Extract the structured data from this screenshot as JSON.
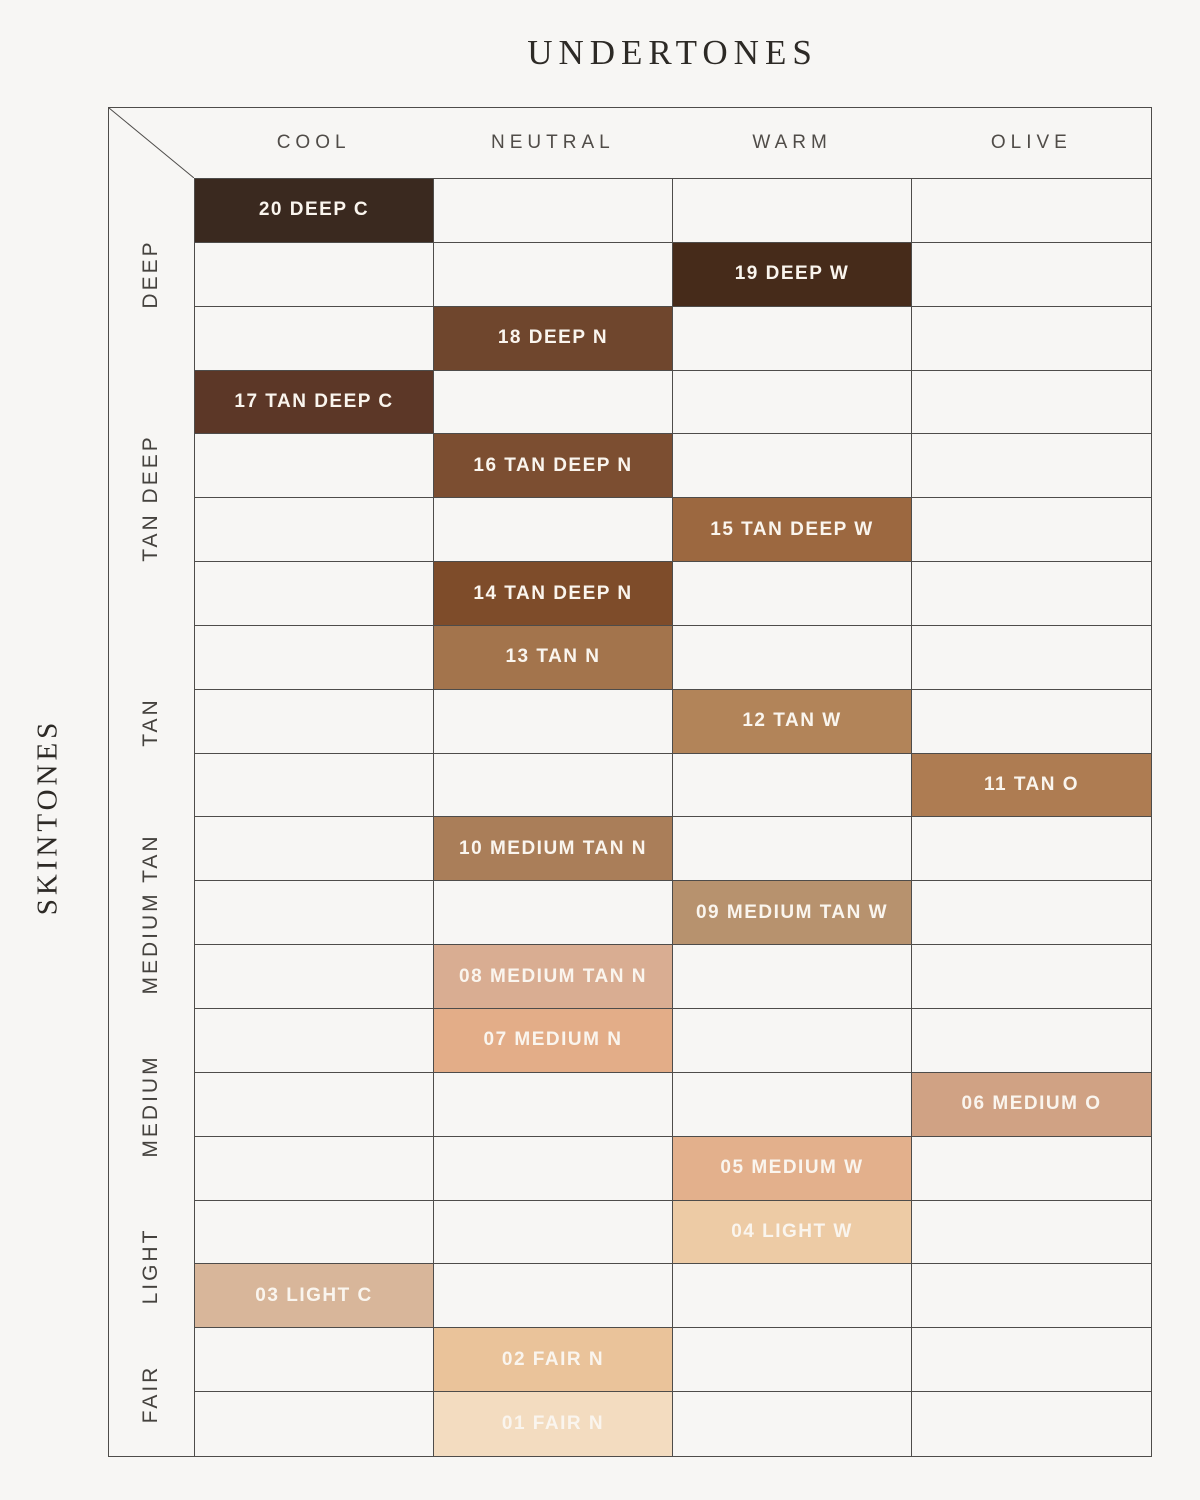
{
  "title": "UNDERTONES",
  "side_label": "SKINTONES",
  "columns": [
    {
      "key": "cool",
      "label": "COOL"
    },
    {
      "key": "neutral",
      "label": "NEUTRAL"
    },
    {
      "key": "warm",
      "label": "WARM"
    },
    {
      "key": "olive",
      "label": "OLIVE"
    }
  ],
  "row_groups": [
    {
      "label": "DEEP",
      "rows": 3
    },
    {
      "label": "TAN DEEP",
      "rows": 4
    },
    {
      "label": "TAN",
      "rows": 3
    },
    {
      "label": "MEDIUM TAN",
      "rows": 3
    },
    {
      "label": "MEDIUM",
      "rows": 3
    },
    {
      "label": "LIGHT",
      "rows": 2
    },
    {
      "label": "FAIR",
      "rows": 2
    }
  ],
  "shades": [
    {
      "row": 1,
      "undertone": "cool",
      "skintone": "DEEP",
      "number": "20",
      "label": "20 DEEP C",
      "color": "#3a291f"
    },
    {
      "row": 2,
      "undertone": "warm",
      "skintone": "DEEP",
      "number": "19",
      "label": "19 DEEP W",
      "color": "#462b1a"
    },
    {
      "row": 3,
      "undertone": "neutral",
      "skintone": "DEEP",
      "number": "18",
      "label": "18 DEEP N",
      "color": "#6f462d"
    },
    {
      "row": 4,
      "undertone": "cool",
      "skintone": "TAN DEEP",
      "number": "17",
      "label": "17 TAN DEEP C",
      "color": "#5c3727"
    },
    {
      "row": 5,
      "undertone": "neutral",
      "skintone": "TAN DEEP",
      "number": "16",
      "label": "16 TAN DEEP N",
      "color": "#7c4e31"
    },
    {
      "row": 6,
      "undertone": "warm",
      "skintone": "TAN DEEP",
      "number": "15",
      "label": "15 TAN DEEP W",
      "color": "#9c6840"
    },
    {
      "row": 7,
      "undertone": "neutral",
      "skintone": "TAN DEEP",
      "number": "14",
      "label": "14 TAN DEEP N",
      "color": "#7e4c2a"
    },
    {
      "row": 8,
      "undertone": "neutral",
      "skintone": "TAN",
      "number": "13",
      "label": "13 TAN N",
      "color": "#a3744c"
    },
    {
      "row": 9,
      "undertone": "warm",
      "skintone": "TAN",
      "number": "12",
      "label": "12 TAN W",
      "color": "#b28459"
    },
    {
      "row": 10,
      "undertone": "olive",
      "skintone": "TAN",
      "number": "11",
      "label": "11 TAN O",
      "color": "#ae7c52"
    },
    {
      "row": 11,
      "undertone": "neutral",
      "skintone": "MEDIUM TAN",
      "number": "10",
      "label": "10 MEDIUM TAN N",
      "color": "#aa7e59"
    },
    {
      "row": 12,
      "undertone": "warm",
      "skintone": "MEDIUM TAN",
      "number": "09",
      "label": "09 MEDIUM TAN W",
      "color": "#b7926e"
    },
    {
      "row": 13,
      "undertone": "neutral",
      "skintone": "MEDIUM TAN",
      "number": "08",
      "label": "08 MEDIUM TAN N",
      "color": "#d9ad92"
    },
    {
      "row": 14,
      "undertone": "neutral",
      "skintone": "MEDIUM",
      "number": "07",
      "label": "07 MEDIUM N",
      "color": "#e3ad88"
    },
    {
      "row": 15,
      "undertone": "olive",
      "skintone": "MEDIUM",
      "number": "06",
      "label": "06 MEDIUM O",
      "color": "#d0a284"
    },
    {
      "row": 16,
      "undertone": "warm",
      "skintone": "MEDIUM",
      "number": "05",
      "label": "05 MEDIUM W",
      "color": "#e3b08c"
    },
    {
      "row": 17,
      "undertone": "warm",
      "skintone": "LIGHT",
      "number": "04",
      "label": "04 LIGHT W",
      "color": "#edcba5"
    },
    {
      "row": 18,
      "undertone": "cool",
      "skintone": "LIGHT",
      "number": "03",
      "label": "03 LIGHT C",
      "color": "#d8b69a"
    },
    {
      "row": 19,
      "undertone": "neutral",
      "skintone": "FAIR",
      "number": "02",
      "label": "02 FAIR N",
      "color": "#eac39a"
    },
    {
      "row": 20,
      "undertone": "neutral",
      "skintone": "FAIR",
      "number": "01",
      "label": "01 FAIR N",
      "color": "#f3dcc0"
    }
  ],
  "colors": {
    "background": "#f7f6f4",
    "grid_line": "#4e4c4a",
    "title_text": "#2d2a26",
    "header_text": "#504c48",
    "group_text": "#45423e",
    "shade_text": "#faf5ee"
  },
  "chart_data": {
    "type": "table",
    "title": "UNDERTONES",
    "column_axis_label": "UNDERTONES",
    "row_axis_label": "SKINTONES",
    "columns": [
      "COOL",
      "NEUTRAL",
      "WARM",
      "OLIVE"
    ],
    "row_groups": [
      "DEEP",
      "TAN DEEP",
      "TAN",
      "MEDIUM TAN",
      "MEDIUM",
      "LIGHT",
      "FAIR"
    ],
    "cells": [
      {
        "shade": "20 DEEP C",
        "skintone": "DEEP",
        "undertone": "COOL",
        "swatch": "#3a291f"
      },
      {
        "shade": "19 DEEP W",
        "skintone": "DEEP",
        "undertone": "WARM",
        "swatch": "#462b1a"
      },
      {
        "shade": "18 DEEP N",
        "skintone": "DEEP",
        "undertone": "NEUTRAL",
        "swatch": "#6f462d"
      },
      {
        "shade": "17 TAN DEEP C",
        "skintone": "TAN DEEP",
        "undertone": "COOL",
        "swatch": "#5c3727"
      },
      {
        "shade": "16 TAN DEEP N",
        "skintone": "TAN DEEP",
        "undertone": "NEUTRAL",
        "swatch": "#7c4e31"
      },
      {
        "shade": "15 TAN DEEP W",
        "skintone": "TAN DEEP",
        "undertone": "WARM",
        "swatch": "#9c6840"
      },
      {
        "shade": "14 TAN DEEP N",
        "skintone": "TAN DEEP",
        "undertone": "NEUTRAL",
        "swatch": "#7e4c2a"
      },
      {
        "shade": "13 TAN N",
        "skintone": "TAN",
        "undertone": "NEUTRAL",
        "swatch": "#a3744c"
      },
      {
        "shade": "12 TAN W",
        "skintone": "TAN",
        "undertone": "WARM",
        "swatch": "#b28459"
      },
      {
        "shade": "11 TAN O",
        "skintone": "TAN",
        "undertone": "OLIVE",
        "swatch": "#ae7c52"
      },
      {
        "shade": "10 MEDIUM TAN N",
        "skintone": "MEDIUM TAN",
        "undertone": "NEUTRAL",
        "swatch": "#aa7e59"
      },
      {
        "shade": "09 MEDIUM TAN W",
        "skintone": "MEDIUM TAN",
        "undertone": "WARM",
        "swatch": "#b7926e"
      },
      {
        "shade": "08 MEDIUM TAN N",
        "skintone": "MEDIUM TAN",
        "undertone": "NEUTRAL",
        "swatch": "#d9ad92"
      },
      {
        "shade": "07 MEDIUM N",
        "skintone": "MEDIUM",
        "undertone": "NEUTRAL",
        "swatch": "#e3ad88"
      },
      {
        "shade": "06 MEDIUM O",
        "skintone": "MEDIUM",
        "undertone": "OLIVE",
        "swatch": "#d0a284"
      },
      {
        "shade": "05 MEDIUM W",
        "skintone": "MEDIUM",
        "undertone": "WARM",
        "swatch": "#e3b08c"
      },
      {
        "shade": "04 LIGHT W",
        "skintone": "LIGHT",
        "undertone": "WARM",
        "swatch": "#edcba5"
      },
      {
        "shade": "03 LIGHT C",
        "skintone": "LIGHT",
        "undertone": "COOL",
        "swatch": "#d8b69a"
      },
      {
        "shade": "02 FAIR N",
        "skintone": "FAIR",
        "undertone": "NEUTRAL",
        "swatch": "#eac39a"
      },
      {
        "shade": "01 FAIR N",
        "skintone": "FAIR",
        "undertone": "NEUTRAL",
        "swatch": "#f3dcc0"
      }
    ]
  }
}
